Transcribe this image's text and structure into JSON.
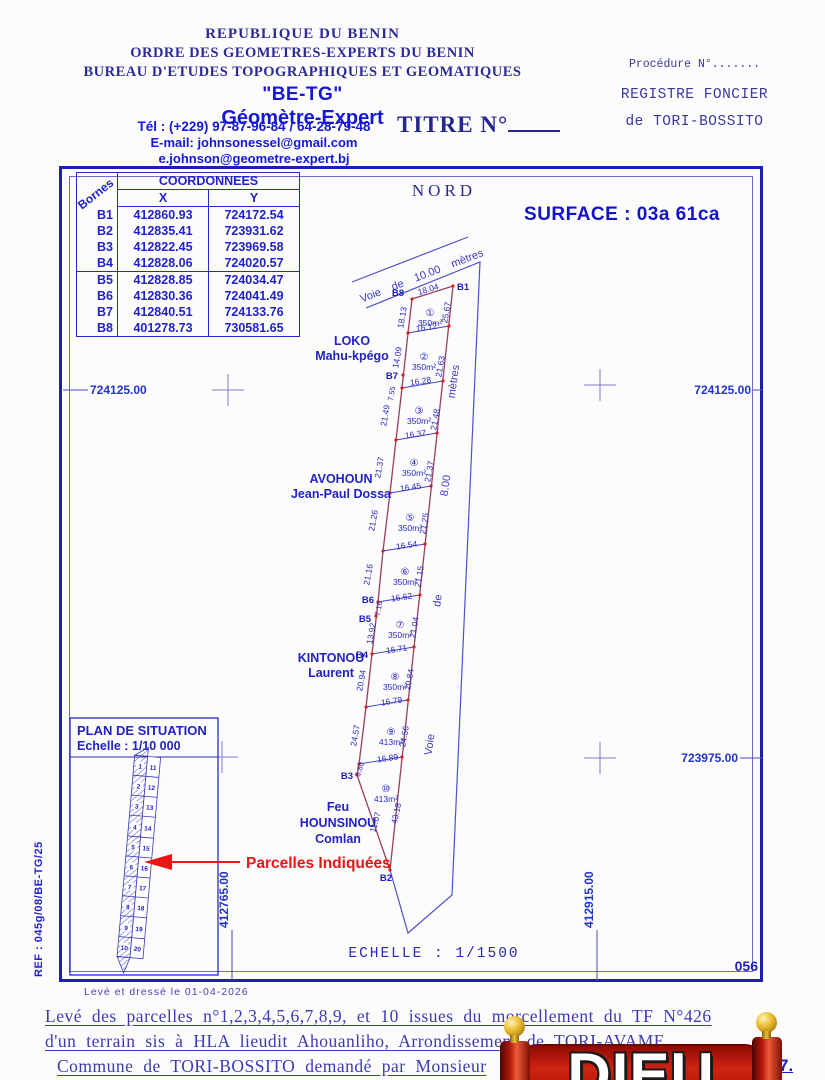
{
  "header": {
    "org1": "REPUBLIQUE DU BENIN",
    "org2": "ORDRE DES GEOMETRES-EXPERTS DU BENIN",
    "org3": "BUREAU D'ETUDES TOPOGRAPHIQUES ET GEOMATIQUES",
    "firm": "\"BE-TG\"",
    "role": "Géomètre-Expert",
    "tel": "Tél : (+229) 97-87-96-84 / 64-28-79-48",
    "email1": "E-mail: johnsonessel@gmail.com",
    "email2": "e.johnson@geometre-expert.bj",
    "title": "TITRE N°",
    "procedure": "Procédure N°.......",
    "registre_line1": "REGISTRE FONCIER",
    "registre_line2": "de TORI-BOSSITO"
  },
  "table": {
    "corner": "Bornes",
    "title": "COORDONNEES",
    "col_x": "X",
    "col_y": "Y",
    "rows": [
      [
        "B1",
        "412860.93",
        "724172.54"
      ],
      [
        "B2",
        "412835.41",
        "723931.62"
      ],
      [
        "B3",
        "412822.45",
        "723969.58"
      ],
      [
        "B4",
        "412828.06",
        "724020.57"
      ],
      [
        "B5",
        "412828.85",
        "724034.47"
      ],
      [
        "B6",
        "412830.36",
        "724041.49"
      ],
      [
        "B7",
        "412840.51",
        "724133.76"
      ],
      [
        "B8",
        "401278.73",
        "730581.65"
      ]
    ]
  },
  "plan": {
    "north_label": "NORD",
    "surface": "SURFACE : 03a  61ca",
    "road_top": "Voie de 10.00 mètres",
    "road_right": {
      "w1": "Voie",
      "w2": "de",
      "w3": "8.00",
      "w4": "mètres"
    },
    "grid": {
      "left_724125": "724125.00",
      "right_724125": "724125.00",
      "right_723975": "723975.00",
      "bottom_412765": "412765.00",
      "bottom_412915": "412915.00"
    },
    "bornes": {
      "b1": "B1",
      "b2": "B2",
      "b3": "B3",
      "b4": "B4",
      "b5": "B5",
      "b6": "B6",
      "b7": "B7",
      "b8": "B8"
    },
    "parcels": [
      {
        "n": "①",
        "area": "350m²",
        "top": "18.04",
        "left": "18.13",
        "right": "25.67",
        "bottom": "16.12"
      },
      {
        "n": "②",
        "area": "350m²",
        "left": "14.09",
        "left2": "7.55",
        "right": "21.63",
        "bottom": "16.28"
      },
      {
        "n": "③",
        "area": "350m²",
        "left": "21.49",
        "right": "21.48",
        "bottom": "16.37"
      },
      {
        "n": "④",
        "area": "350m²",
        "left": "21.37",
        "right": "21.37",
        "bottom": "16.45"
      },
      {
        "n": "⑤",
        "area": "350m²",
        "left": "21.26",
        "right": "21.25",
        "bottom": "16.54"
      },
      {
        "n": "⑥",
        "area": "350m²",
        "left": "21.16",
        "right": "21.15",
        "bottom": "16.62"
      },
      {
        "n": "⑦",
        "area": "350m²",
        "left": "13.92",
        "left2": "7.16",
        "right": "21.04",
        "bottom": "16.71"
      },
      {
        "n": "⑧",
        "area": "350m²",
        "left": "20.94",
        "right": "20.84",
        "bottom": "16.79"
      },
      {
        "n": "⑨",
        "area": "413m²",
        "left": "24.57",
        "right": "24.56",
        "bottom": "16.89"
      },
      {
        "n": "⑩",
        "area": "413m²",
        "left": "11.07",
        "left2": "5.80",
        "right": "43.18"
      }
    ],
    "neighbors": [
      {
        "l1": "LOKO",
        "l2": "Mahu-kpégo"
      },
      {
        "l1": "AVOHOUN",
        "l2": "Jean-Paul Dossa"
      },
      {
        "l1": "KINTONOU",
        "l2": "Laurent"
      },
      {
        "l1": "Feu",
        "l2": "HOUNSINOU",
        "l3": "Comlan"
      }
    ],
    "scale_label": "ECHELLE : 1/1500",
    "sheet": "056"
  },
  "inset": {
    "title": "PLAN DE SITUATION",
    "scale": "Echelle : 1/10 000",
    "arrow_label": "Parcelles Indiquées",
    "nums_left": [
      "1",
      "2",
      "3",
      "4",
      "5",
      "6",
      "7",
      "8",
      "9",
      "10"
    ],
    "nums_right": [
      "11",
      "12",
      "13",
      "14",
      "15",
      "16",
      "17",
      "18",
      "19",
      "20"
    ]
  },
  "footer": {
    "drawn": "Levé et dressé  le 01-04-2026",
    "ref": "REF : 045g/08/BE-TG/25",
    "line1": "Levé des parcelles n°1,2,3,4,5,6,7,8,9, et 10 issues du morcellement du TF N°426",
    "line2": "d'un terrain sis à HLA lieudit Ahouanliho, Arrondissement de TORI-AVAME,",
    "line3": "Commune de TORI-BOSSITO demandé par Monsieur",
    "line3_end": "7.",
    "logo_text": "DIEU"
  }
}
